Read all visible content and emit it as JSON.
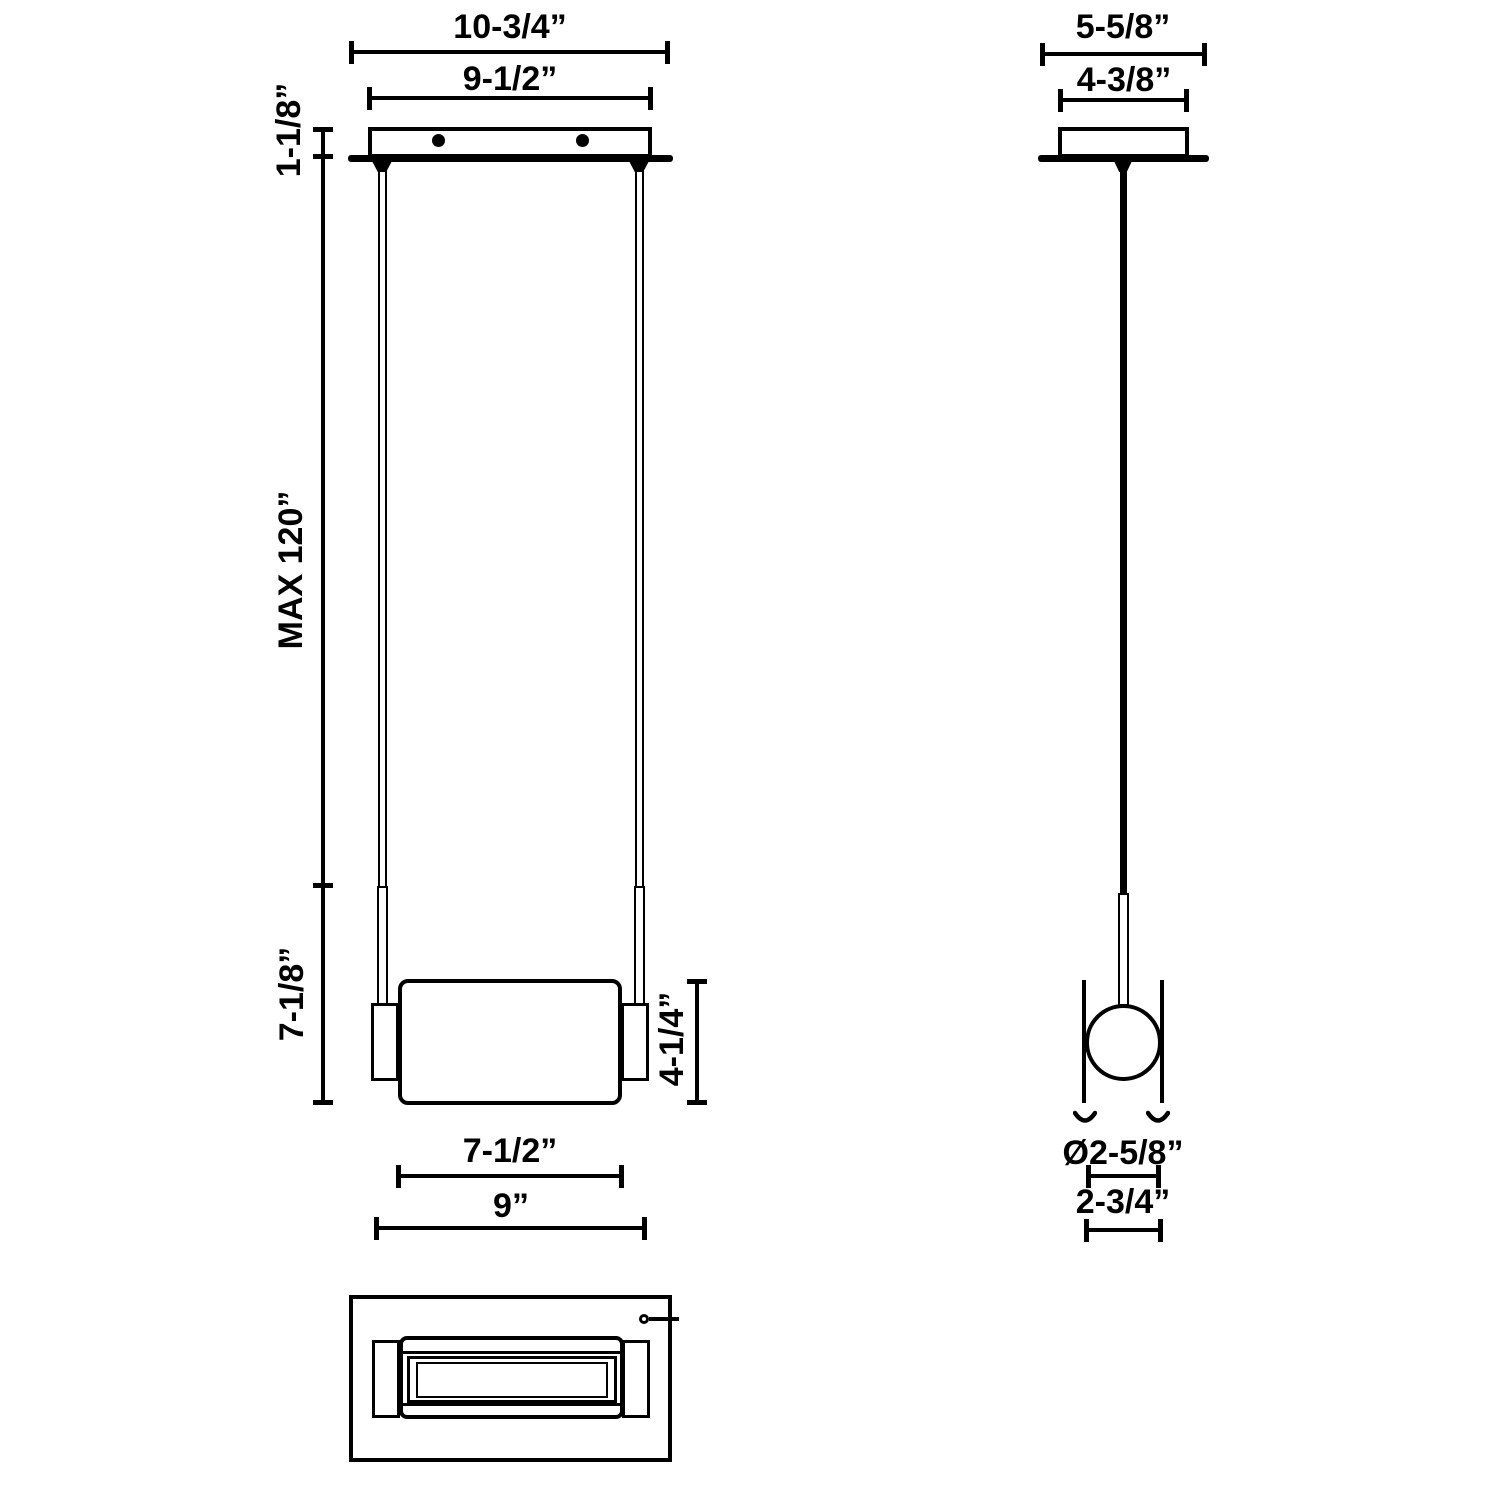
{
  "front_view": {
    "canopy_outer_width": "10-3/4”",
    "canopy_inner_width": "9-1/2”",
    "canopy_height": "1-1/8”",
    "max_suspension_length": "MAX 120”",
    "lower_section_height": "7-1/8”",
    "shade_height": "4-1/4”",
    "shade_width": "7-1/2”",
    "overall_fixture_width": "9”"
  },
  "side_view": {
    "canopy_outer_depth": "5-5/8”",
    "canopy_inner_depth": "4-3/8”",
    "shade_diameter": "Ø2-5/8”",
    "overall_fixture_depth": "2-3/4”"
  }
}
